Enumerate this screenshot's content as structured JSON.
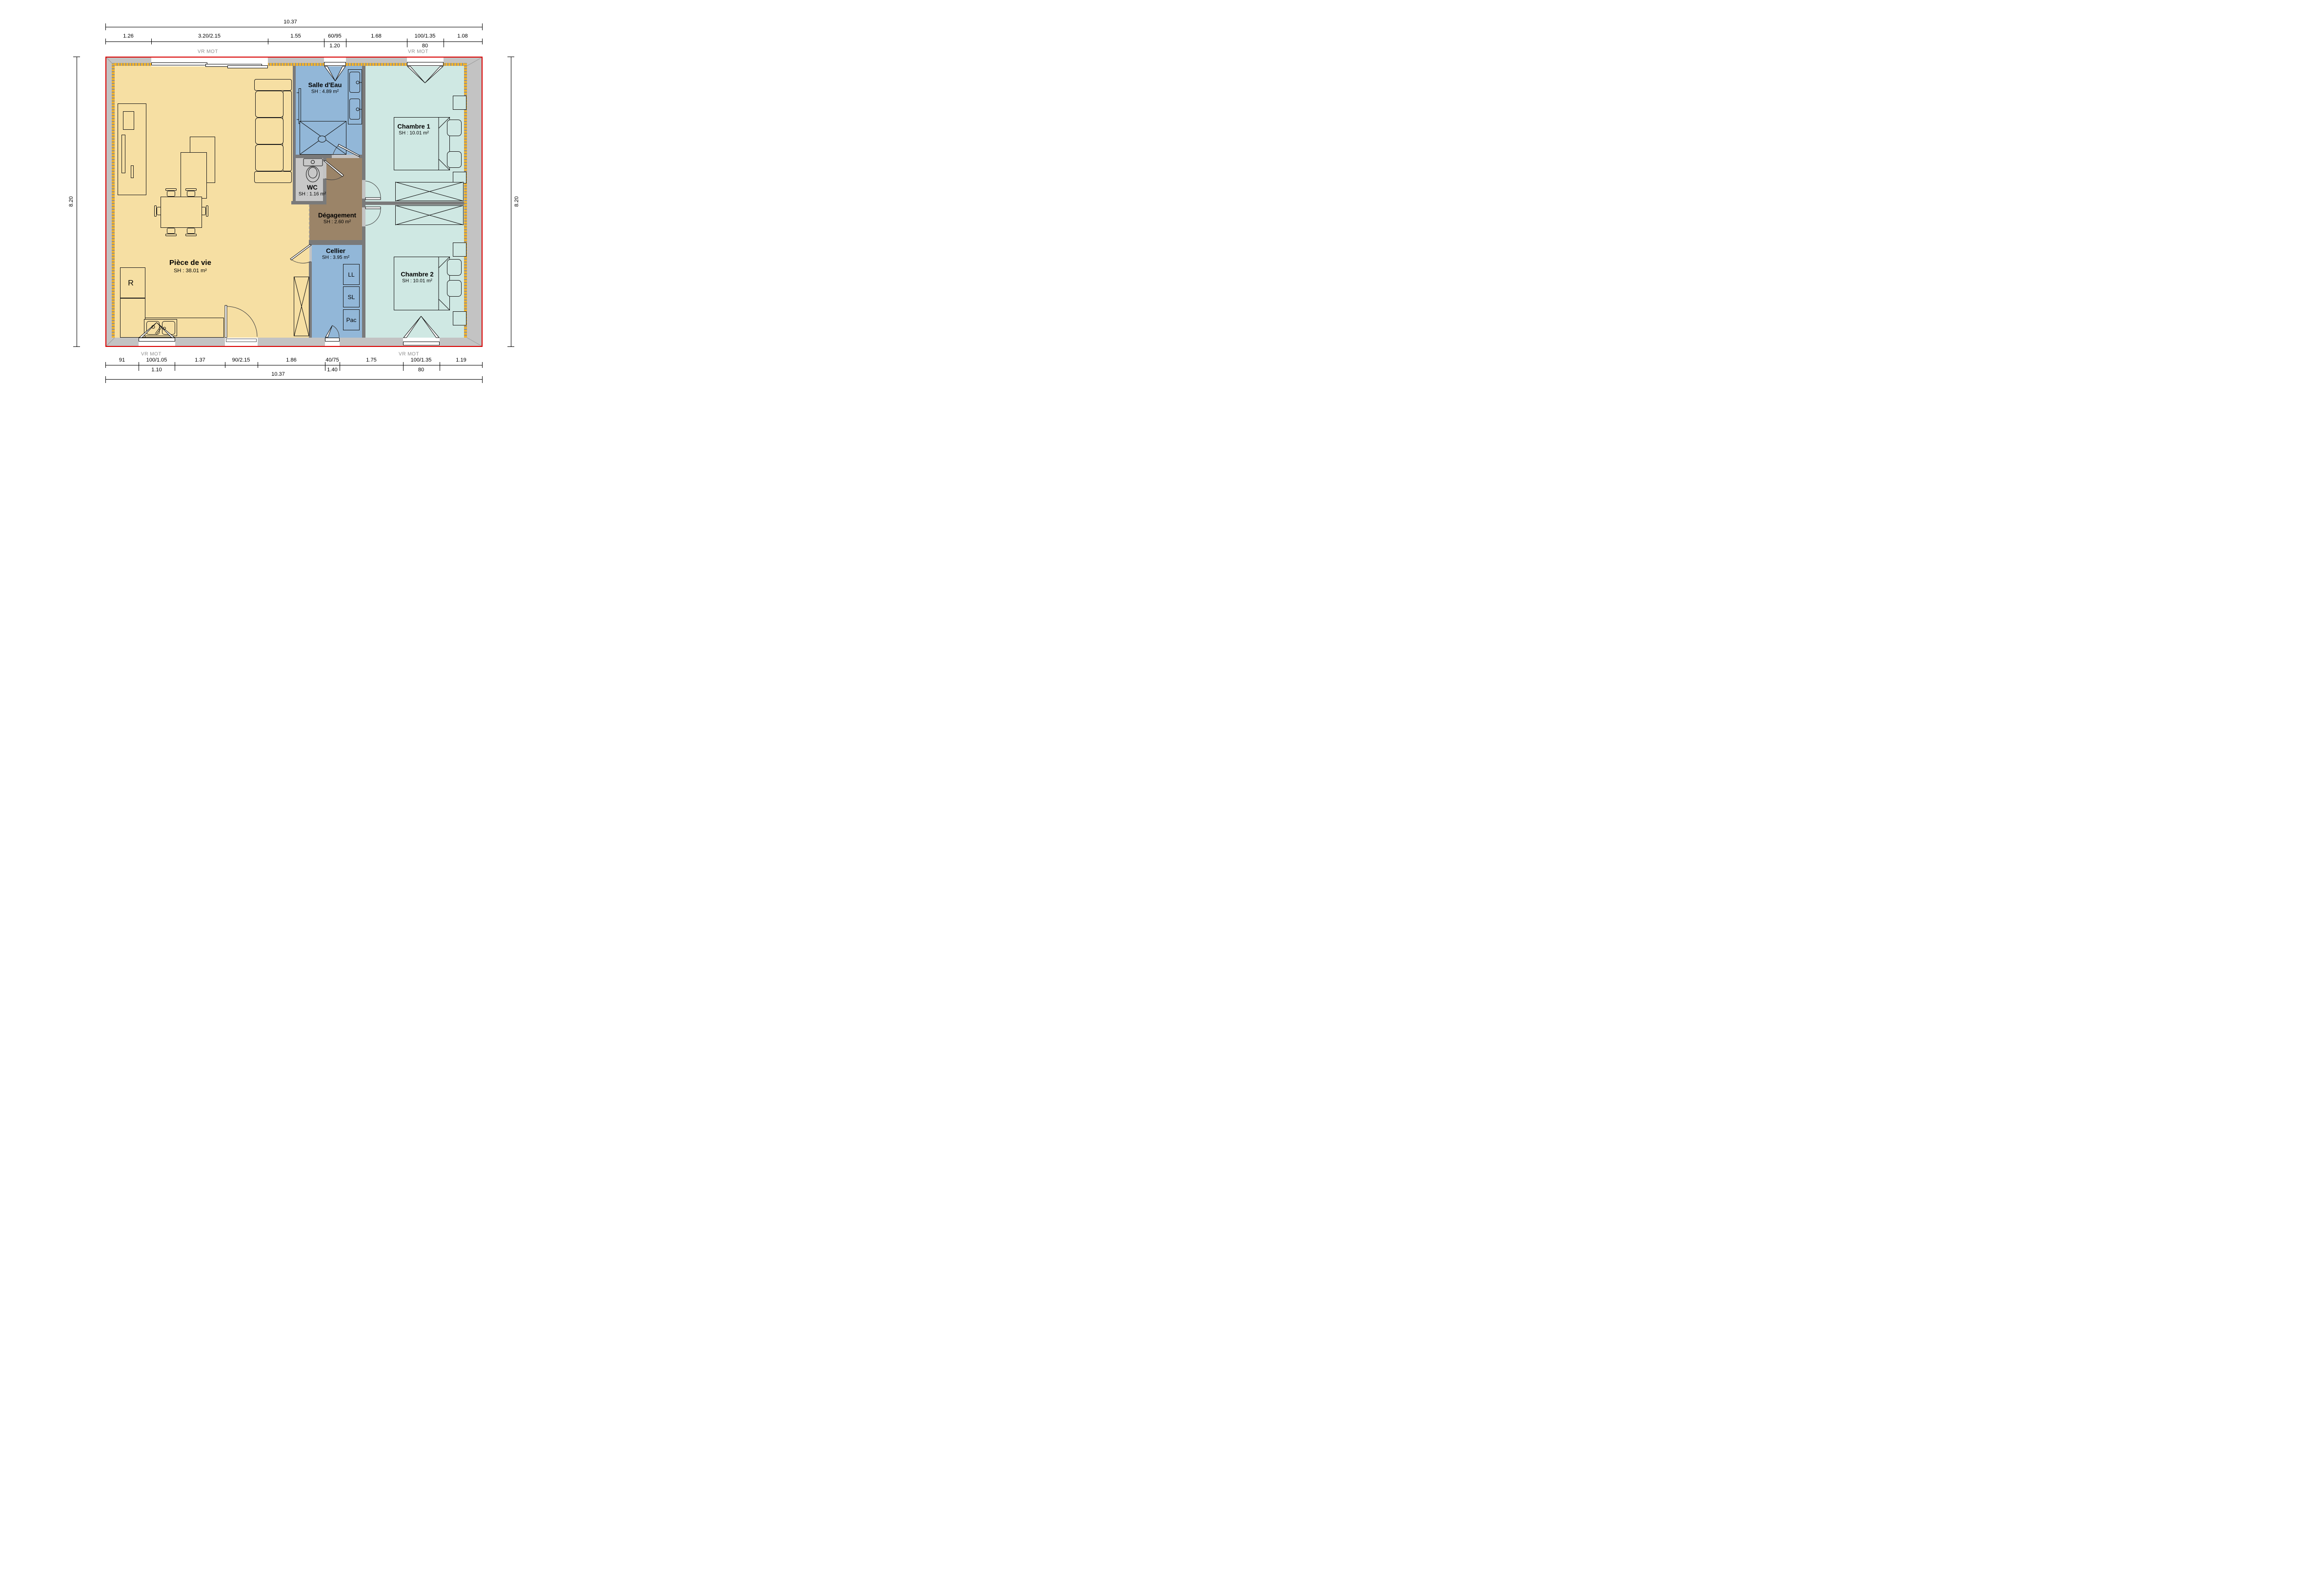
{
  "plan_title": "Plan de maison plain-pied",
  "dimensions": {
    "top": {
      "overall": "10.37",
      "segments": [
        "1.26",
        "3.20/2.15",
        "1.55",
        "60/95",
        "1.68",
        "100/1.35",
        "1.08"
      ],
      "sub_window_60": "1.20",
      "sub_window_100": "80"
    },
    "bottom": {
      "overall": "10.37",
      "segments": [
        "91",
        "100/1.05",
        "1.37",
        "90/2.15",
        "1.86",
        "40/75",
        "1.75",
        "100/1.35",
        "1.19"
      ],
      "sub_window_100_105": "1.10",
      "sub_window_40_75": "1.40",
      "sub_window_100_135": "80"
    },
    "left": "8.20",
    "right": "8.20"
  },
  "shutter_labels": {
    "top_left": "VR MOT",
    "top_right": "VR MOT",
    "bottom_left": "VR MOT",
    "bottom_right": "VR MOT"
  },
  "rooms": {
    "piece_de_vie": {
      "name": "Pièce de vie",
      "area": "SH : 38.01 m²"
    },
    "salle_eau": {
      "name": "Salle d'Eau",
      "area": "SH : 4.89 m²"
    },
    "wc": {
      "name": "WC",
      "area": "SH : 1.16 m²"
    },
    "degagement": {
      "name": "Dégagement",
      "area": "SH : 2.60 m²"
    },
    "cellier": {
      "name": "Cellier",
      "area": "SH : 3.95 m²"
    },
    "chambre1": {
      "name": "Chambre 1",
      "area": "SH : 10.01 m²"
    },
    "chambre2": {
      "name": "Chambre 2",
      "area": "SH : 10.01 m²"
    }
  },
  "appliances": {
    "fridge": "R",
    "washing_machine": "LL",
    "dryer": "SL",
    "heat_pump": "Pac"
  },
  "colors": {
    "living": "#f6dfa3",
    "water_rooms": "#92b7d8",
    "bedrooms": "#cfe8e3",
    "hallway": "#9b8468",
    "wc_floor": "#c8c8c8",
    "exterior_wall": "#c3c3c3",
    "partition": "#7a7a7a",
    "insulation": "#f0b22d",
    "outline_red": "#d90000"
  }
}
